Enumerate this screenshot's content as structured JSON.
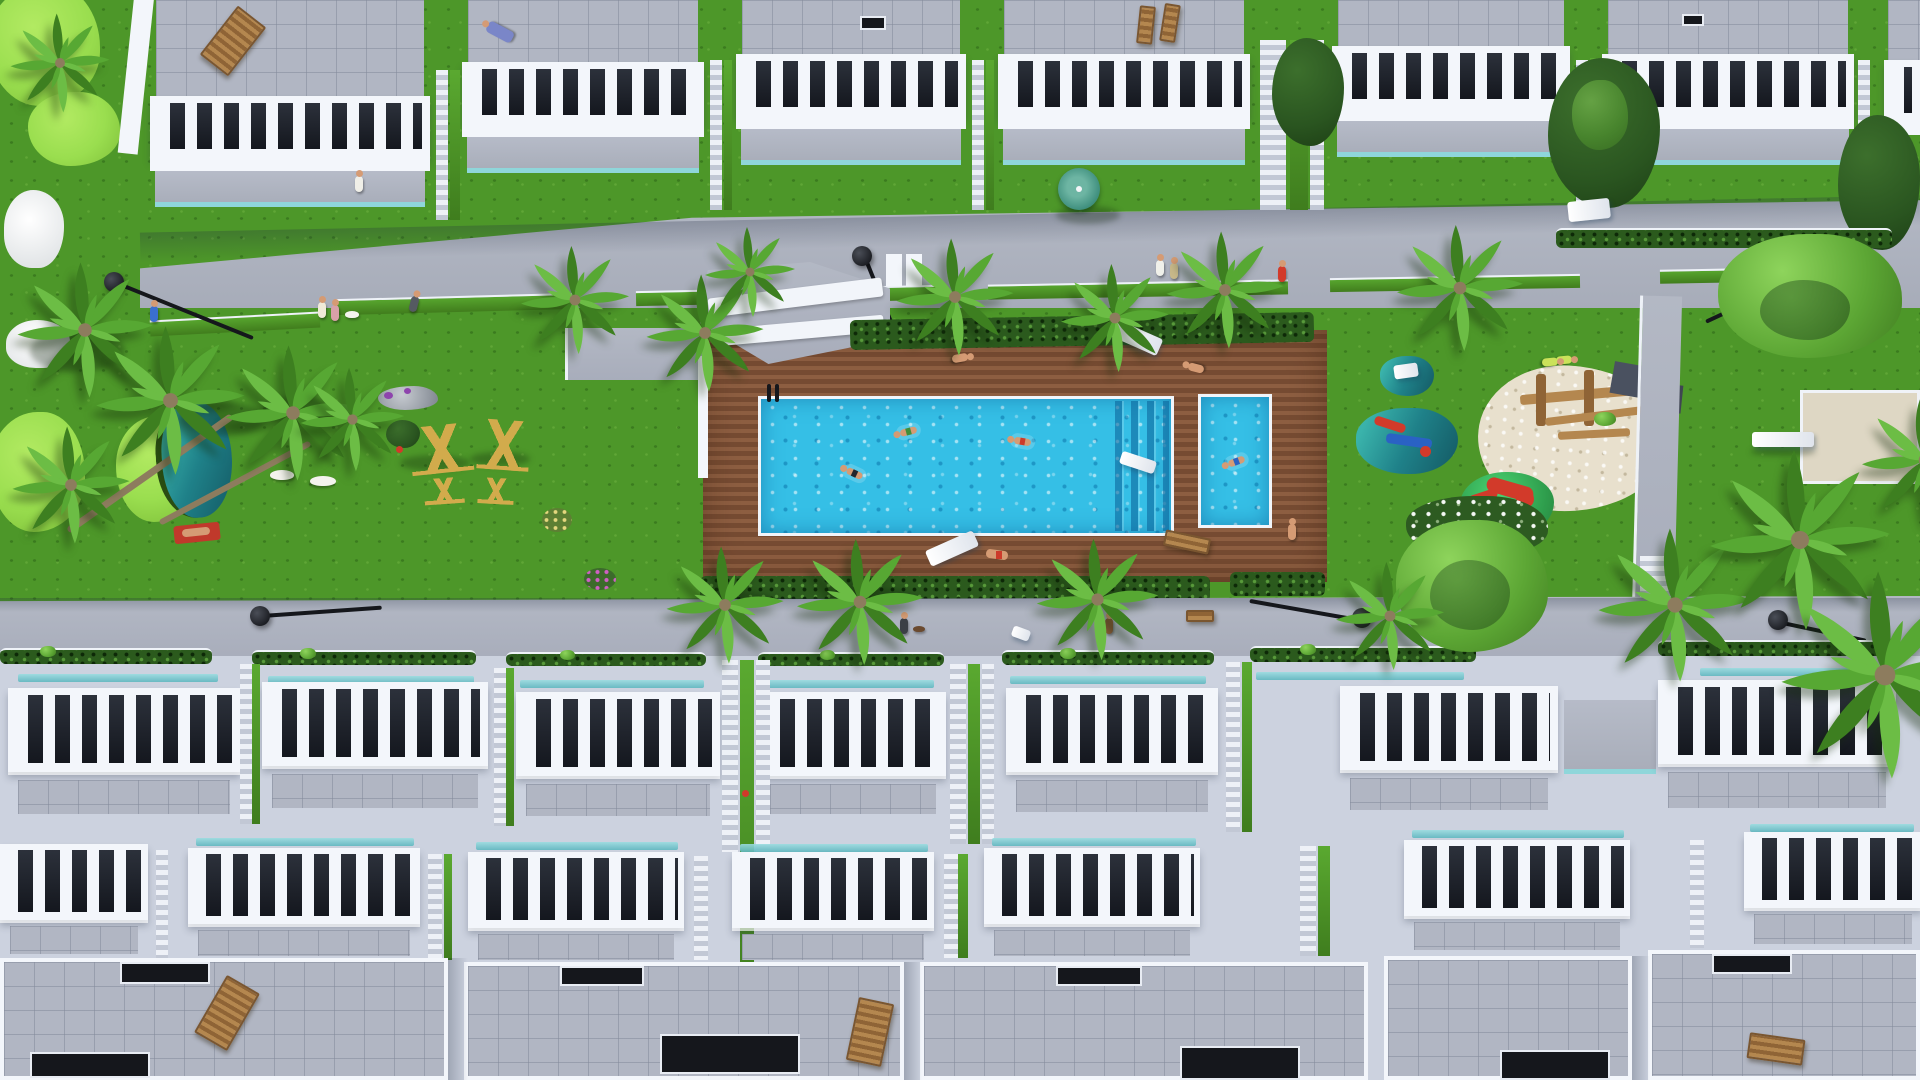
{
  "meta": {
    "title": "Top-down aerial 3D architectural rendering of a white residential complex with communal pool, timber deck, gardens and playground",
    "image_kind": "3D exterior visualization",
    "view": "top-down aerial",
    "visible_text": "none"
  },
  "colors": {
    "lawn": "#4d9729",
    "golfGreen": "#9ade4f",
    "street": "#a7acb9",
    "walk": "#b3b8c4",
    "building": "#edf1f8",
    "frame": "#f3f6fb",
    "slot": "#14171e",
    "roof": "#b1b6c3",
    "roofLine": "rgba(130,138,155,0.55)",
    "deckA": "#8d5e41",
    "deckB": "#764b32",
    "water": "#35bfe6",
    "glass": "#8fd6da",
    "hedge": "#2b5a1d",
    "sand": "#e8e0cd",
    "court": "#ded7c4",
    "trunk": "#8d7c5e",
    "palmA": "#57a833",
    "palmB": "#3d7f20",
    "palmC": "#6cbd45",
    "skin": "#d59b74",
    "wood": "#b4874f",
    "yellowWood": "#d2ab4c",
    "dark": "#15171c",
    "red": "#d23a2a",
    "teal1": "#3ab3ab",
    "teal2": "#16616b",
    "mound": "#2f9e4d",
    "baseBottom": "#ccd2df"
  },
  "scene": {
    "top_building_row": {
      "name": "upper row of white terraced apartments",
      "blocks": 7,
      "features": [
        "grey tiled roof terraces",
        "chunky white balustrade railings",
        "glass-fronted lower terraces",
        "staircases between blocks",
        "timber deck chair on roof",
        "person sunbathing on roof",
        "teal patio umbrella"
      ]
    },
    "upper_street": {
      "name": "palm-lined pedestrian street",
      "lamps": 3,
      "palms": 7,
      "pedestrians": 6
    },
    "left_garden": {
      "name": "golf-style garden",
      "features": [
        "light putting greens",
        "white sand bunkers",
        "teal pond",
        "palm cluster with leaning trunks",
        "two white dogs",
        "sunbather on red towel",
        "rocks with purple flowers",
        "timber exercise frames"
      ]
    },
    "pool_area": {
      "name": "communal pool on timber deck",
      "main_pool": {
        "shape": "long rectangle",
        "corner_steps": "right end",
        "ladder": "top-left",
        "swimmers": 3,
        "float": "white inflatable"
      },
      "kids_pool": {
        "shape": "small rectangle",
        "swimmers": 1
      },
      "ramp": "white switchback access ramp at deck top-left",
      "hedge": "ornamental grass border along deck",
      "sun_loungers": 4,
      "people_on_deck": 3
    },
    "playground": {
      "name": "children playground",
      "features": [
        "sand pit with timber climbing frame and slate roofs",
        "two teal splash pads with play equipment",
        "green mound with red slide",
        "white flowering shrub",
        "large round tree"
      ]
    },
    "right_garden": {
      "name": "east lawn",
      "features": [
        "leafy tree",
        "beige boules court",
        "white bench",
        "street lamp",
        "tall palms"
      ]
    },
    "lower_walkway": {
      "name": "palm-lined promenade",
      "lamps": 3,
      "pedestrians": 4
    },
    "bottom_building_rows": {
      "name": "two stepped rows of roof terraces with rooftops below",
      "row1_units": 7,
      "row2_units": 7,
      "features": [
        "white balustrades",
        "teal glass balustrade strips",
        "agave planter hedges",
        "central staircase with planting",
        "rooftop timber loungers",
        "dark skylight voids"
      ]
    }
  }
}
